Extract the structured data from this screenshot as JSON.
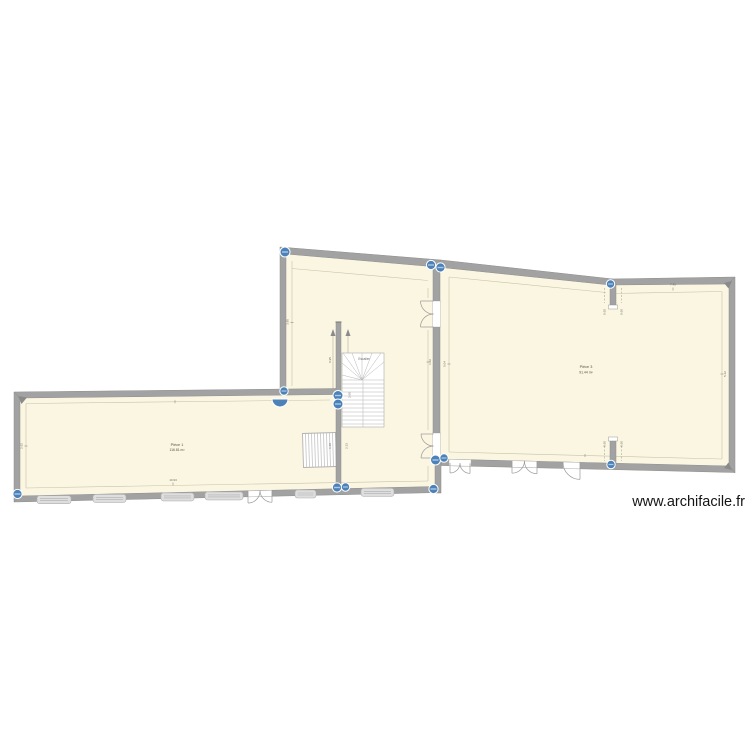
{
  "watermark": "www.archifacile.fr",
  "rooms": {
    "left": {
      "name": "Pièce 1",
      "area": "116.81 m²"
    },
    "right": {
      "name": "Pièce 3",
      "area": "91.44 m²"
    }
  },
  "stair": {
    "label": "Escalier",
    "width_dim": "0.95",
    "height_dim": "2.60",
    "lower_a": "1.10",
    "lower_b": "2.33"
  },
  "dims": {
    "left_w": "10.93",
    "left_h": "2.62",
    "mid_h": "3.95",
    "door_mid": "1.02",
    "right_t": "7.45",
    "right_l": "5.04",
    "right_r": "5.12",
    "stub_t1": "0.60",
    "stub_t2": "0.60",
    "stub_b1": "0.60",
    "stub_b2": "0.60"
  },
  "colors": {
    "room_fill": "#faf6e2",
    "wall_fill": "#a2a2a2",
    "wall_edge": "#8e8e8e",
    "handle_blue": "#4d82b8",
    "dim_line": "#c9c2a8",
    "door_arc": "#999999",
    "window_fill": "#dedede"
  }
}
